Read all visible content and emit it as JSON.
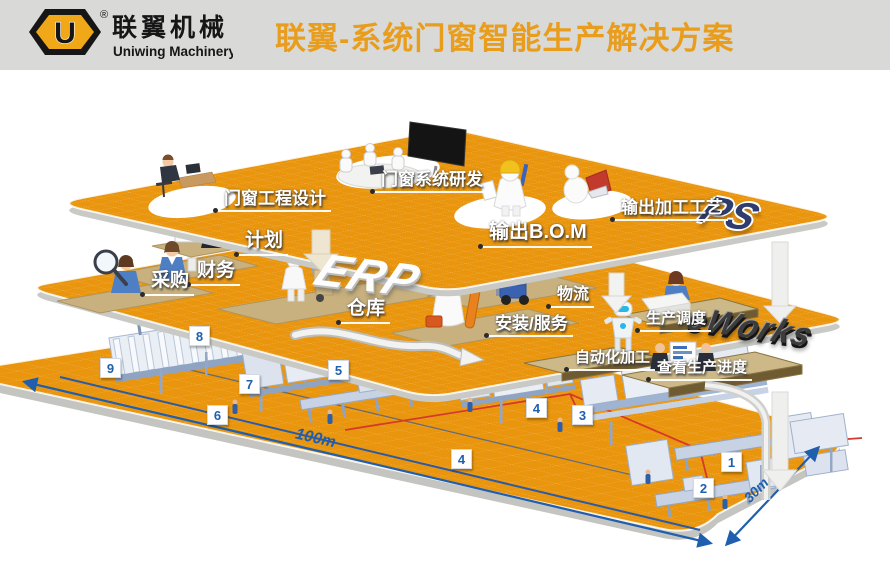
{
  "header": {
    "logo_letter": "U",
    "logo_reg": "®",
    "logo_cn": "联翼机械",
    "logo_en": "Uniwing Machinery",
    "title": "联翼-系统门窗智能生产解决方案"
  },
  "platforms": {
    "ps": {
      "name": "PS",
      "stations": {
        "design": "门窗工程设计",
        "rd": "门窗系统研发",
        "bom": "输出B.O.M",
        "craft": "输出加工工艺"
      }
    },
    "erp": {
      "name": "ERP",
      "stations": {
        "plan": "计划",
        "finance": "财务",
        "purchase": "采购",
        "warehouse": "仓库",
        "logistics": "物流",
        "install": "安装/服务"
      }
    },
    "eworks": {
      "name": "eWorks",
      "stations": {
        "dispatch": "生产调度",
        "auto": "自动化加工",
        "progress": "查看生产进度"
      }
    }
  },
  "floor": {
    "length_label": "100m",
    "width_label": "30m",
    "markers": [
      "1",
      "2",
      "3",
      "4",
      "4",
      "5",
      "6",
      "7",
      "8",
      "9"
    ]
  },
  "colors": {
    "platform_orange": "#E9950D",
    "title_orange": "#E99D1C",
    "marker_blue": "#1F5FAE",
    "flow_red": "#D6392B",
    "pad_tan": "#C8B17E"
  }
}
